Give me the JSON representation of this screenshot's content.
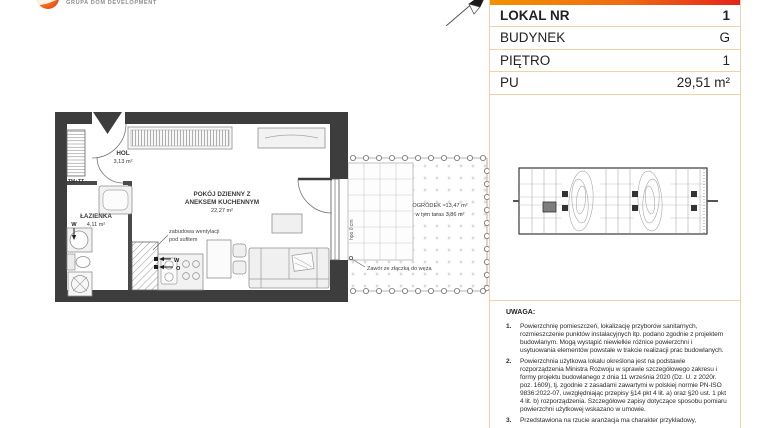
{
  "header": {
    "logo_text": "GRUPA DOM DEVELOPMENT"
  },
  "info_table": {
    "rows": [
      {
        "label": "LOKAL NR",
        "value": "1"
      },
      {
        "label": "BUDYNEK",
        "value": "G"
      },
      {
        "label": "PIĘTRO",
        "value": "1"
      },
      {
        "label": "PU",
        "value": "29,51 m²"
      }
    ]
  },
  "floor_plan": {
    "rooms": {
      "hol": {
        "name": "HOL",
        "area": "3,13 m²"
      },
      "lazienka": {
        "name": "ŁAZIENKA",
        "area": "4,11 m²"
      },
      "living": {
        "name_line1": "POKÓJ DZIENNY Z",
        "name_line2": "ANEKSEM KUCHENNYM",
        "area": "22,27 m²"
      },
      "garden": {
        "name": "OGRÓDEK  ≈13,47 m²",
        "sub": "w tym taras 3,86 m²"
      }
    },
    "annotations": {
      "vent_line1": "zabudowa wentylacji",
      "vent_line2": "pod sufitem",
      "valve": "Zawór ze złączką do węża",
      "shaft": "TM+TT",
      "water": "W",
      "heat": "O",
      "sill": "hpo 0 cm"
    }
  },
  "notes": {
    "title": "UWAGA:",
    "items": [
      {
        "num": "1.",
        "text": "Powierzchnię pomieszczeń, lokalizację przyborów sanitarnych, rozmieszczenie punktów instalacyjnych itp. podano zgodnie z projektem budowlanym. Mogą wystąpić niewielkie różnice powierzchni i usytuowania elementów powstałe w trakcie realizacji prac budowlanych."
      },
      {
        "num": "2.",
        "text": "Powierzchnia użytkowa lokalu określona jest na podstawie rozporządzenia Ministra Rozwoju w sprawie szczegółowego zakresu i formy projektu budowlanego z dnia 11 września 2020 (Dz. U. z 2020r. poz. 1609), tj. zgodnie z zasadami zawartymi w polskiej normie PN-ISO 9836:2022-07, uwzględniając przepisy §14 pkt 4 lit. a) oraz §20 ust. 1 pkt 4 lit. b) rozporządzenia. Szczegółowe zapisy dotyczące sposobu pomiaru powierzchni użytkowej wskazano w umowie."
      },
      {
        "num": "3.",
        "text": "Przedstawiona na rzucie aranżacja ma charakter przykładowy,"
      }
    ]
  },
  "colors": {
    "accent_gradient_from": "#f39200",
    "accent_gradient_to": "#e5231b",
    "table_border": "#f5cfa8",
    "wall": "#3d3d3d",
    "keyplan_highlight": "#7d7d7d"
  }
}
